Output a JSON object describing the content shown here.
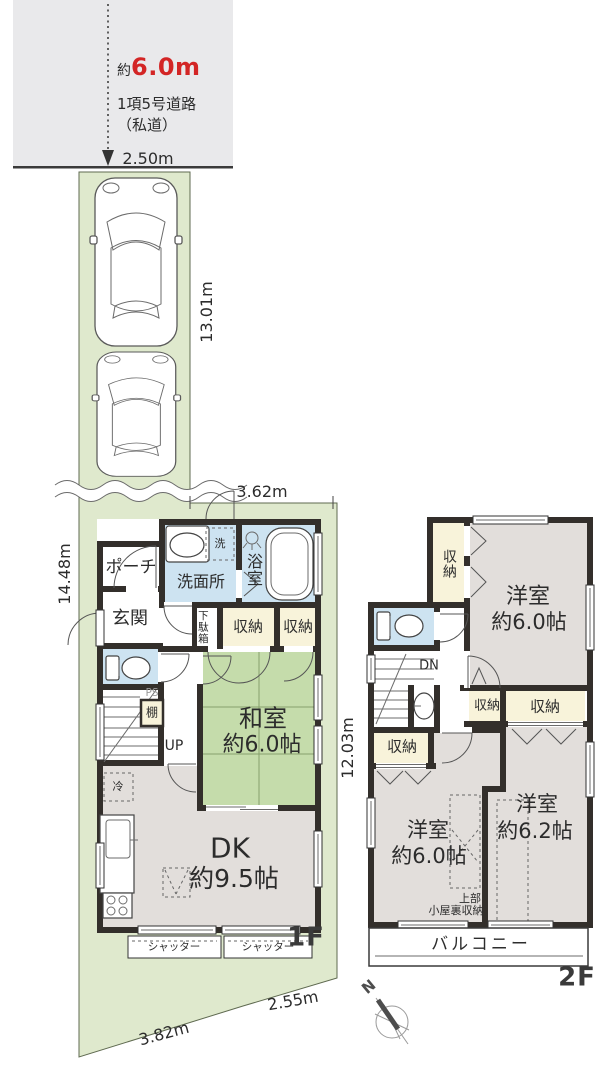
{
  "colors": {
    "road": "#e9e9eb",
    "lot_green": "#dfe9cd",
    "wall": "#332f2b",
    "wet_blue": "#cde3f1",
    "tatami_green": "#c5dcab",
    "closet_cream": "#f8f3da",
    "room_gray": "#e2dedb",
    "text": "#2c2c2c",
    "road_width_red": "#d32525"
  },
  "road": {
    "approx_prefix": "約",
    "width_value": "6.0m",
    "name": "1項5号道路",
    "note": "（私道）"
  },
  "dimensions": {
    "frontage": "2.50m",
    "driveway_length": "13.01m",
    "site_left": "14.48m",
    "site_right": "12.03m",
    "building_top": "3.62m",
    "bottom_right": "2.55m",
    "bottom_left": "3.82m"
  },
  "floor1": {
    "label": "1F",
    "porch": "ポーチ",
    "entrance": "玄関",
    "washroom": "洗面所",
    "bath": "浴室",
    "laundry": "洗",
    "shoebox": "下駄箱",
    "storage_a": "収納",
    "storage_b": "収納",
    "ps": "PS",
    "shelf": "棚",
    "up": "UP",
    "washitsu": {
      "name": "和室",
      "size": "約6.0帖"
    },
    "dk": {
      "name": "DK",
      "size": "約9.5帖"
    },
    "fridge": "冷",
    "shutter_left": "シャッター",
    "shutter_right": "シャッター"
  },
  "floor2": {
    "label": "2F",
    "storage_top": "収納",
    "dn": "DN",
    "room_a": {
      "name": "洋室",
      "size": "約6.0帖"
    },
    "storage_mid_small": "収納",
    "storage_mid_wide": "収納",
    "storage_left": "収納",
    "room_b": {
      "name": "洋室",
      "size": "約6.0帖"
    },
    "room_c": {
      "name": "洋室",
      "size": "約6.2帖"
    },
    "attic_line1": "上部",
    "attic_line2": "小屋裏収納",
    "balcony": "バルコニー"
  },
  "compass": {
    "north_label": "N"
  }
}
